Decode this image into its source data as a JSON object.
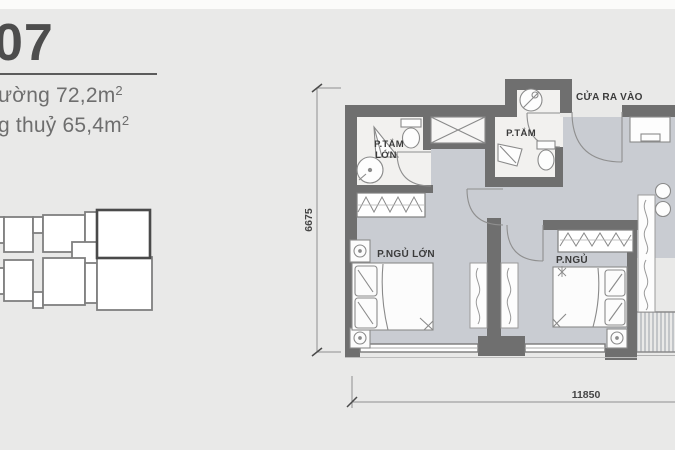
{
  "unit": {
    "number": "07",
    "area1_prefix": "ường 72,2m",
    "area1_sup": "2",
    "area2_prefix": "g thuỷ 65,4m",
    "area2_sup": "2"
  },
  "plan": {
    "labels": {
      "bath_large_1": "P.TẮM",
      "bath_large_2": "LỚN",
      "bath_small": "P.TẮM",
      "entrance": "CỬA RA VÀO",
      "bedroom_master": "P.NGỦ LỚN",
      "bedroom_small": "P.NGỦ"
    },
    "dimensions": {
      "height_mm": "6675",
      "width_mm": "11850"
    }
  },
  "colors": {
    "background": "#e9e9e8",
    "wall": "#6f6f6f",
    "floor": "#c9ccd2",
    "bath_floor": "#f2f1ef",
    "fixture_line": "#8a8a8a",
    "label_text": "#3b3b3b"
  }
}
